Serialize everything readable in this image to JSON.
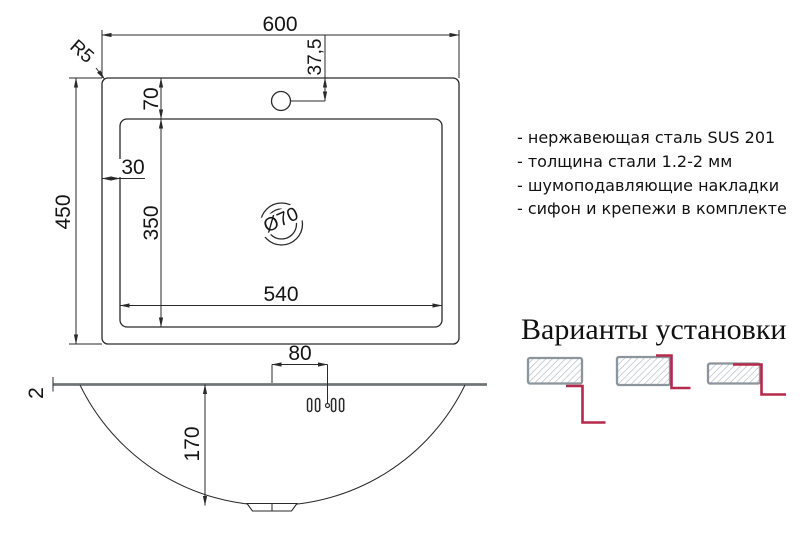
{
  "plan": {
    "width": "600",
    "height": "450",
    "bowl_width": "540",
    "bowl_height": "350",
    "bowl_top_offset": "70",
    "bowl_left_offset": "30",
    "faucet_offset": "37,5",
    "corner_radius": "R5",
    "drain_diameter": "Ø70"
  },
  "section": {
    "faucet_from_center": "80",
    "bowl_depth": "170",
    "rim_thickness": "2"
  },
  "features": {
    "items": [
      "- нержавеющая сталь SUS 201",
      "- толщина стали 1.2-2 мм",
      "- шумоподавляющие накладки",
      "- сифон и крепежи в комплекте"
    ]
  },
  "install": {
    "title": "Варианты установки"
  },
  "colors": {
    "accent_red": "#b5294a",
    "deck_gray": "#6f7577",
    "hatch_line": "#b3bcc6",
    "hatch_border": "#8c959c"
  }
}
